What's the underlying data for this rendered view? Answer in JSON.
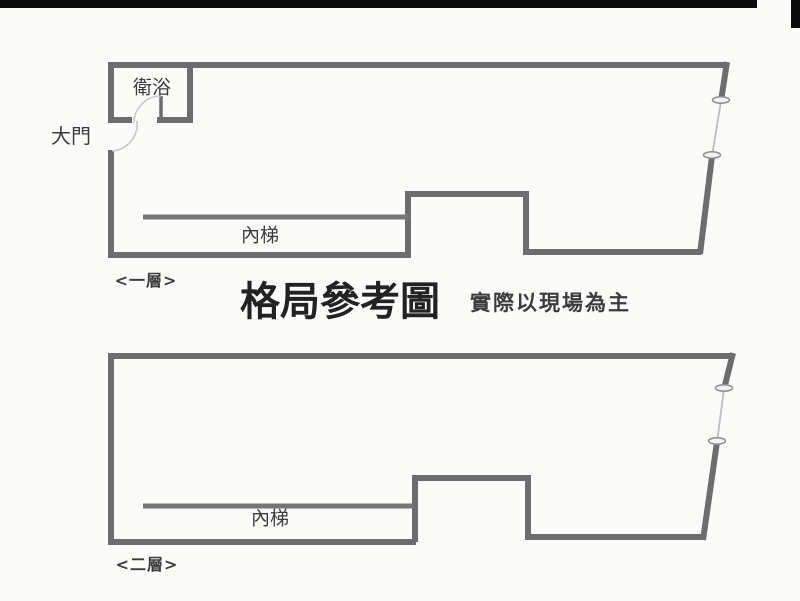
{
  "colors": {
    "background": "#fbfbf9",
    "bar": "#0b0b0b",
    "wall": "#6d6d6d",
    "stair_line": "#757575",
    "thin_line": "#bdbdbd",
    "arc": "#c9c9c9",
    "label_text": "#3c3c3c",
    "title_text": "#222222"
  },
  "title": {
    "main": "格局參考圖",
    "note": "實際以現場為主"
  },
  "floor1": {
    "name": "<一層>",
    "bathroom_label": "衛浴",
    "main_door_label": "大門",
    "stairs_label": "內梯"
  },
  "floor2": {
    "name": "<二層>",
    "stairs_label": "內梯"
  }
}
